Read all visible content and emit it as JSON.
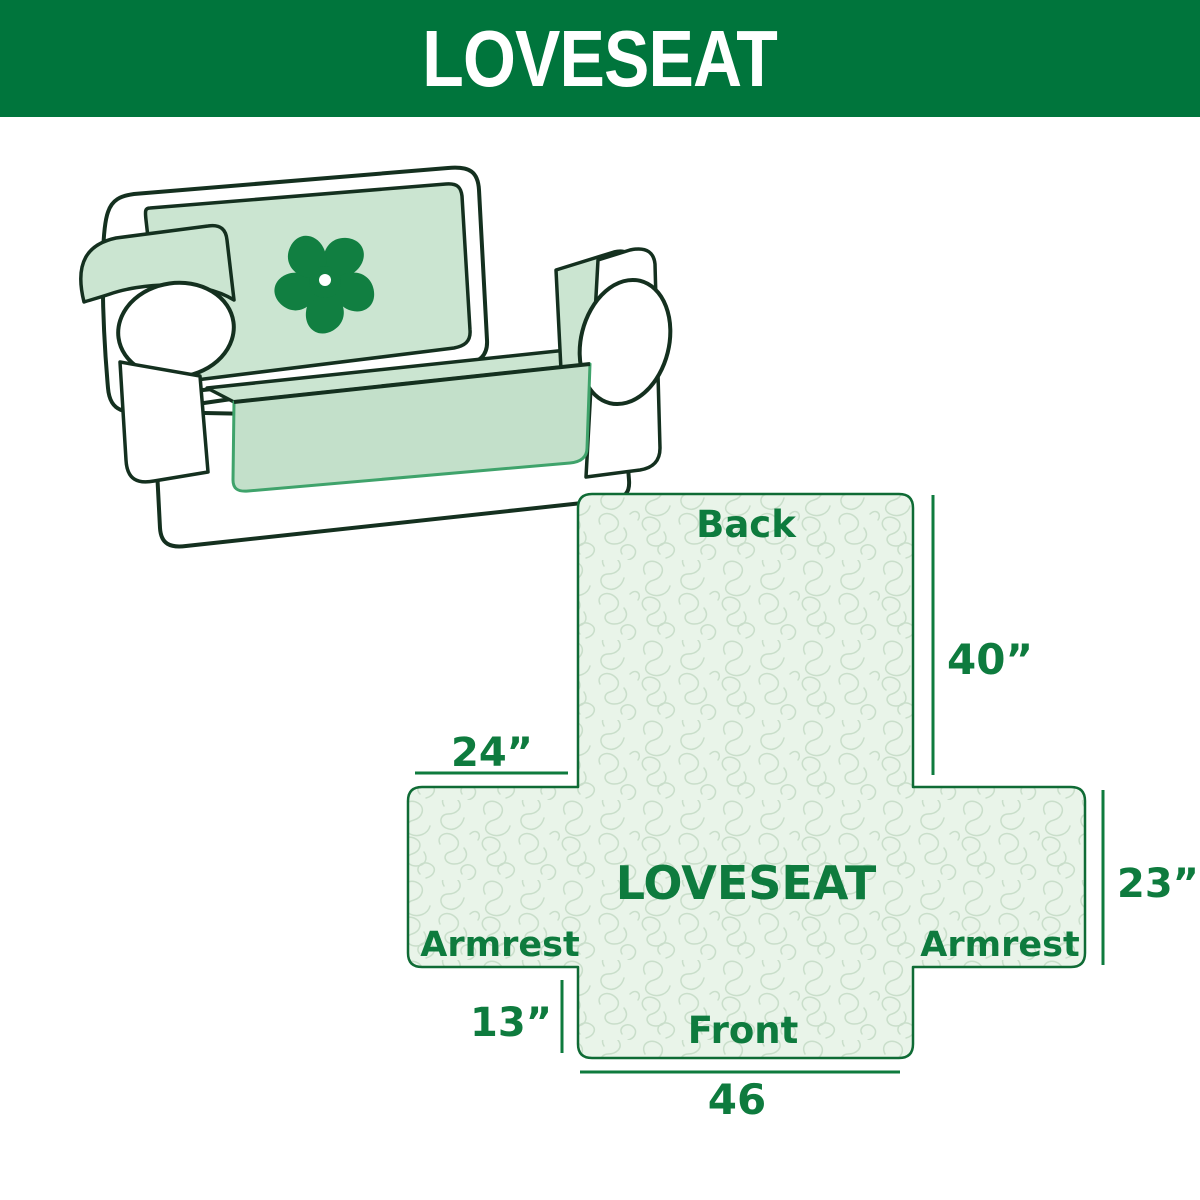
{
  "header": {
    "title": "LOVESEAT"
  },
  "illustration": {
    "name": "loveseat sofa with quilted protective cover",
    "logo_icon": "pinwheel-icon"
  },
  "diagram": {
    "center_label": "LOVESEAT",
    "labels": {
      "back": "Back",
      "front": "Front",
      "armrest_left": "Armrest",
      "armrest_right": "Armrest"
    },
    "dimensions": {
      "back_height": "40”",
      "armrest_top_width": "24”",
      "armrest_height": "23”",
      "front_height": "13”",
      "front_width": "46"
    }
  },
  "colors": {
    "banner_green": "#00753C",
    "text_green": "#0E7B3E",
    "outline_green": "#0F6B35",
    "cover_mint": "#CBE5D1",
    "cover_mint_dark": "#C3E0CA",
    "pattern_bg": "#E9F4E9",
    "pattern_line": "#C9DECA",
    "sofa_outline": "#14301F",
    "skirt_green": "#3FA36B",
    "logo_green": "#117F41"
  }
}
